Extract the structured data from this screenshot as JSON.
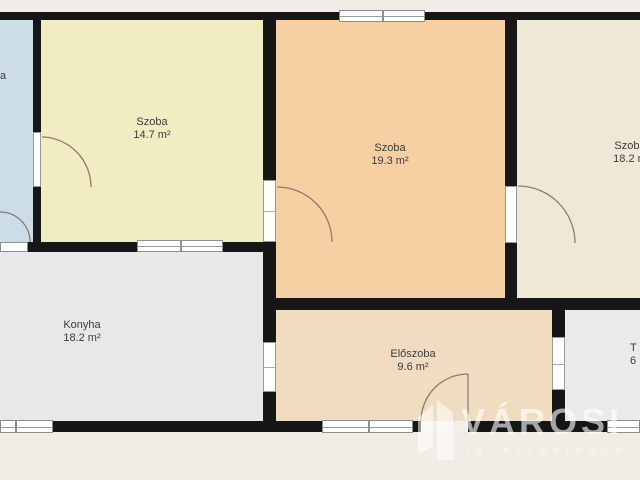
{
  "plan": {
    "title": "apartment-floor-plan",
    "colors": {
      "background": "#f0ede6",
      "wall": "#161616",
      "window_frame": "#8e8e8e",
      "door_arc": "#8d7b69",
      "label_text": "#3b3b3b"
    },
    "rooms": {
      "partial_left": {
        "label": "a",
        "color": "#cddde8"
      },
      "szoba1": {
        "name": "Szoba",
        "area": "14.7 m²",
        "color": "#f2ecc3"
      },
      "szoba2": {
        "name": "Szoba",
        "area": "19.3 m²",
        "color": "#f6d0a3"
      },
      "szoba3": {
        "name": "Szoba",
        "area": "18.2 m",
        "color": "#f0e8d7"
      },
      "konyha": {
        "name": "Konyha",
        "area": "18.2 m²",
        "color": "#e8e8ea"
      },
      "eloszoba": {
        "name": "Előszoba",
        "area": "9.6 m²",
        "color": "#f0ddc1"
      },
      "partial_right": {
        "name": "T",
        "area": "6",
        "color": "#eaeaec"
      }
    },
    "watermark": {
      "brand": "VÁROSI",
      "subtitle": "INGATLANIRODA"
    }
  }
}
